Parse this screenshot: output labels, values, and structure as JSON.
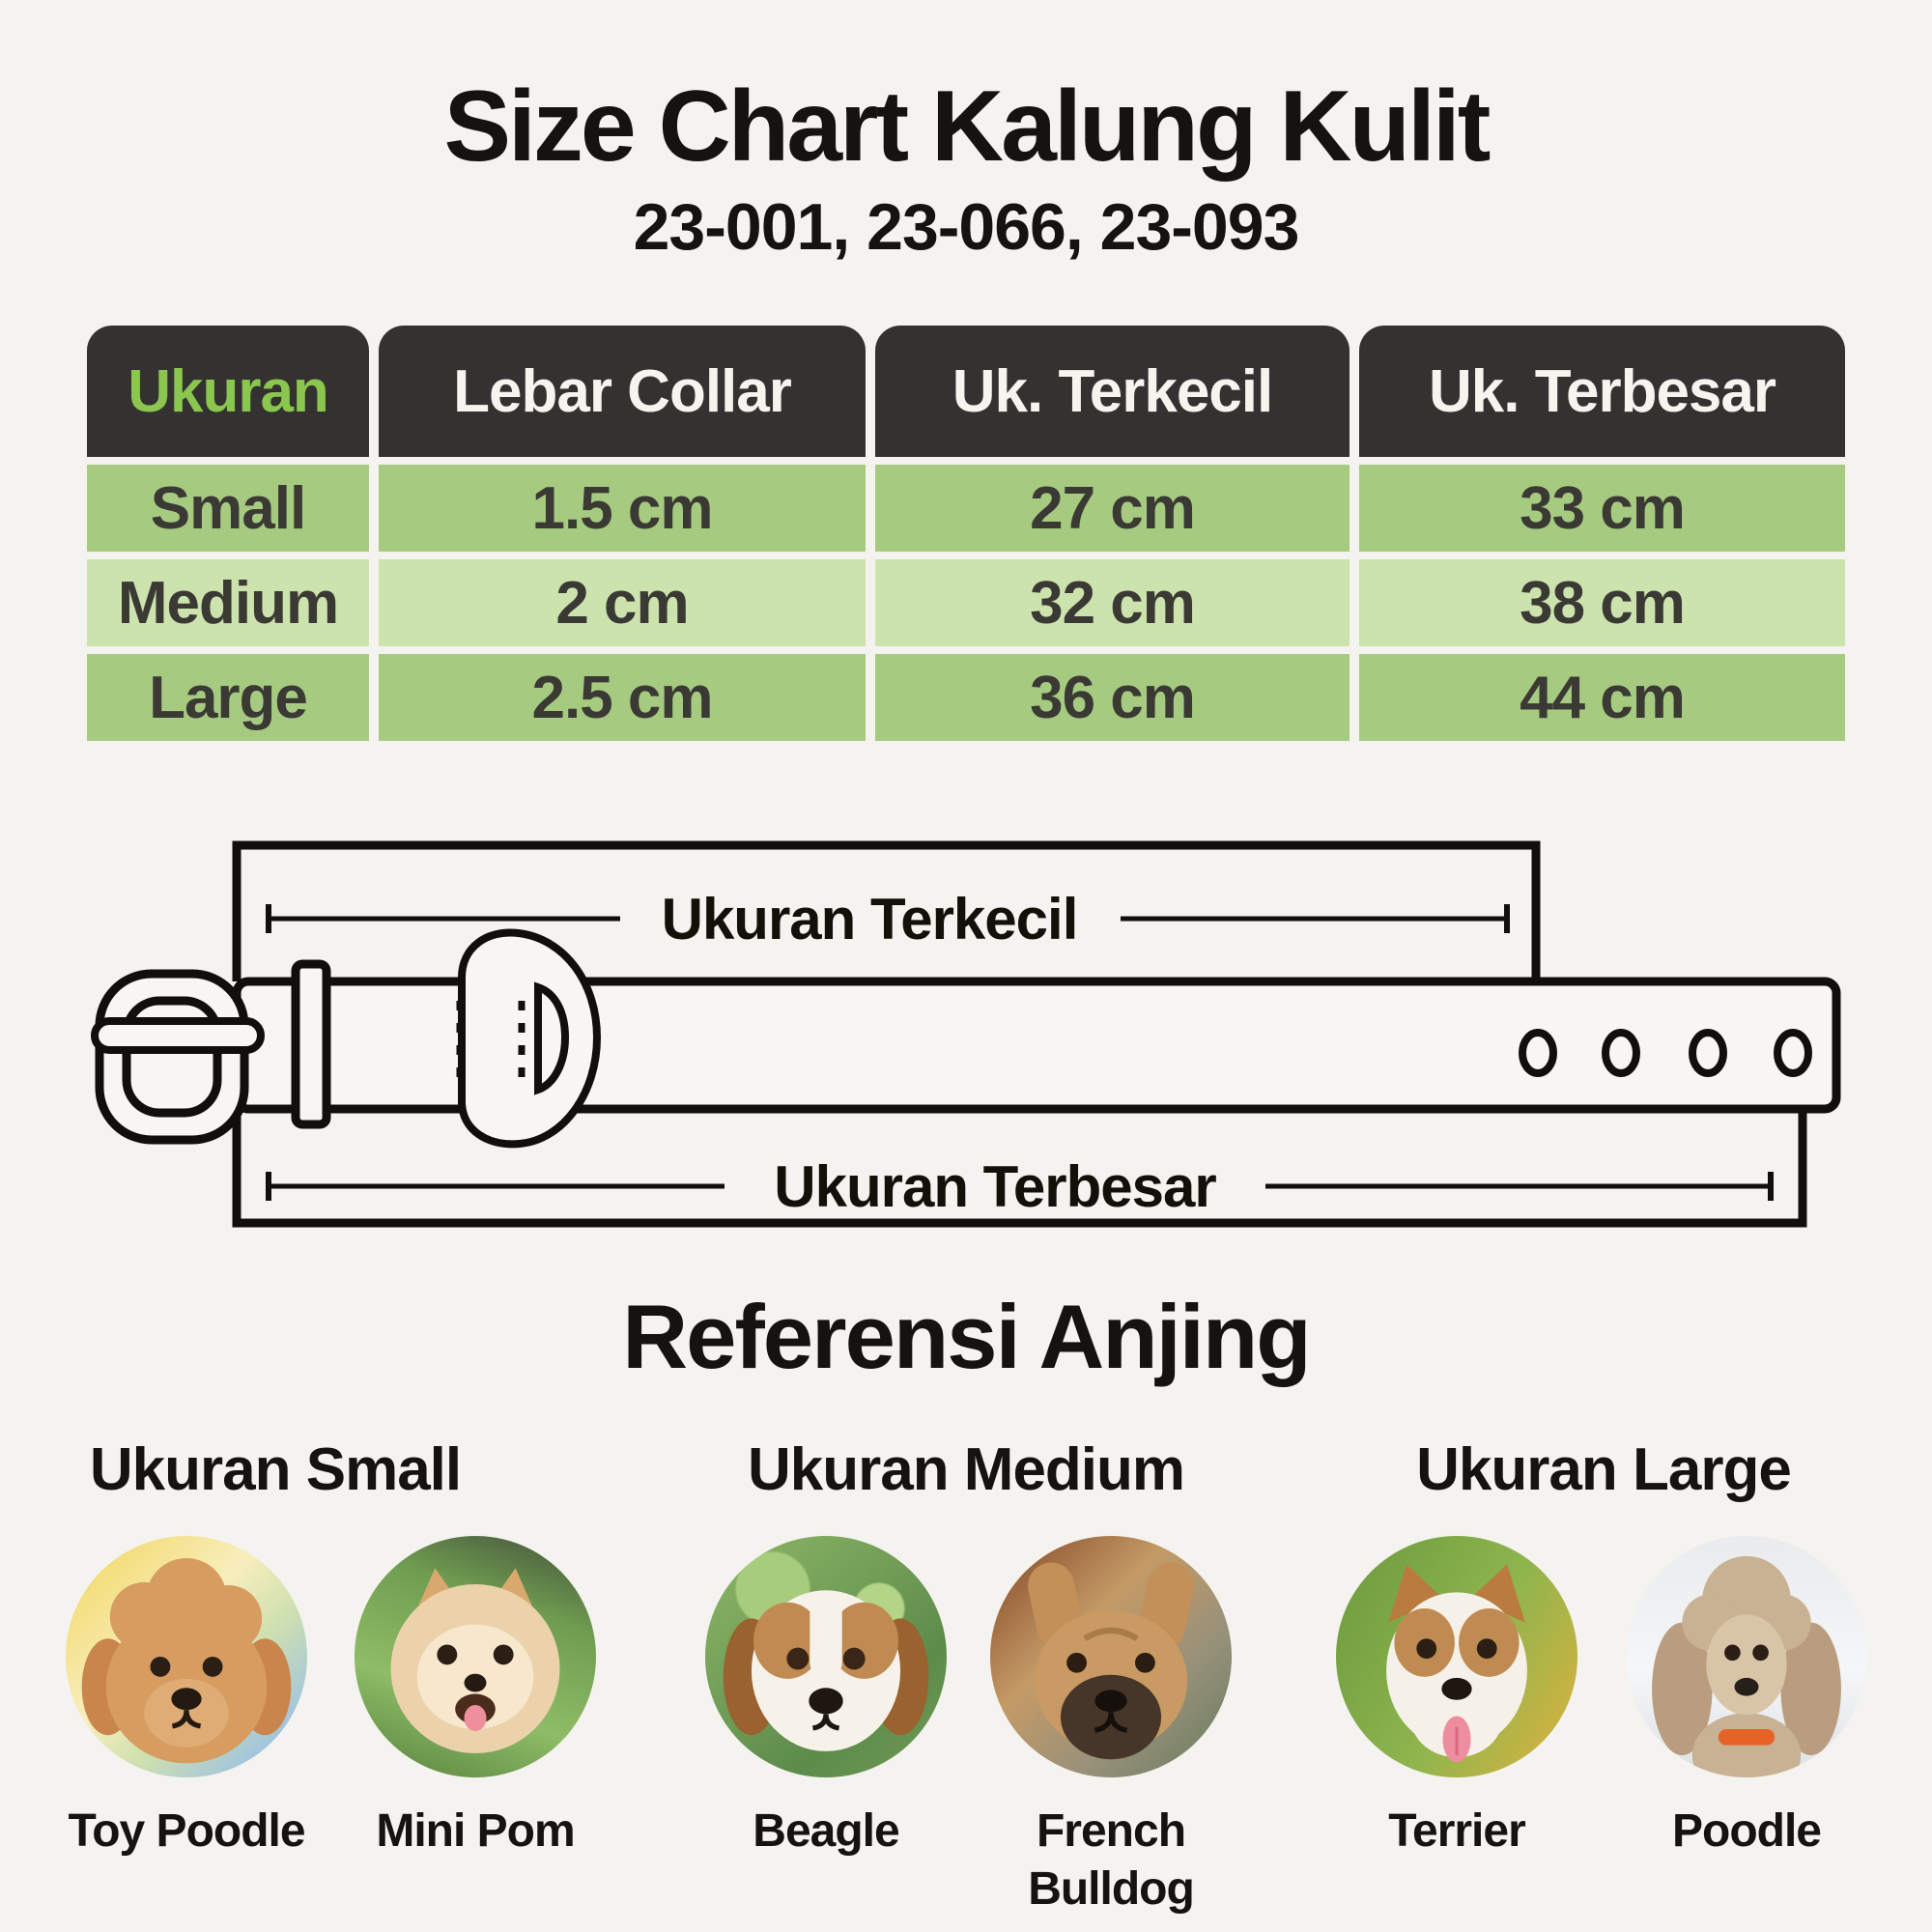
{
  "page": {
    "background_color": "#f5f3ef",
    "accent_green": "#8bc64f",
    "table_header_color": "#343230",
    "row_green": "#a6cb80",
    "row_green_light": "#cce3ae"
  },
  "header": {
    "title": "Size Chart Kalung Kulit",
    "subtitle": "23-001, 23-066, 23-093"
  },
  "size_table": {
    "columns": [
      "Ukuran",
      "Lebar Collar",
      "Uk. Terkecil",
      "Uk. Terbesar"
    ],
    "rows": [
      {
        "ukuran": "Small",
        "lebar_collar": "1.5 cm",
        "uk_terkecil": "27 cm",
        "uk_terbesar": "33 cm"
      },
      {
        "ukuran": "Medium",
        "lebar_collar": "2 cm",
        "uk_terkecil": "32 cm",
        "uk_terbesar": "38 cm"
      },
      {
        "ukuran": "Large",
        "lebar_collar": "2.5 cm",
        "uk_terkecil": "36 cm",
        "uk_terbesar": "44 cm"
      }
    ]
  },
  "diagram": {
    "smallest_label": "Ukuran Terkecil",
    "largest_label": "Ukuran Terbesar"
  },
  "reference": {
    "title": "Referensi Anjing",
    "groups": [
      {
        "label": "Ukuran Small",
        "dogs": [
          {
            "name": "Toy Poodle"
          },
          {
            "name": "Mini Pom"
          }
        ]
      },
      {
        "label": "Ukuran Medium",
        "dogs": [
          {
            "name": "Beagle"
          },
          {
            "name": "French Bulldog"
          }
        ]
      },
      {
        "label": "Ukuran Large",
        "dogs": [
          {
            "name": "Terrier"
          },
          {
            "name": "Poodle"
          }
        ]
      }
    ]
  }
}
